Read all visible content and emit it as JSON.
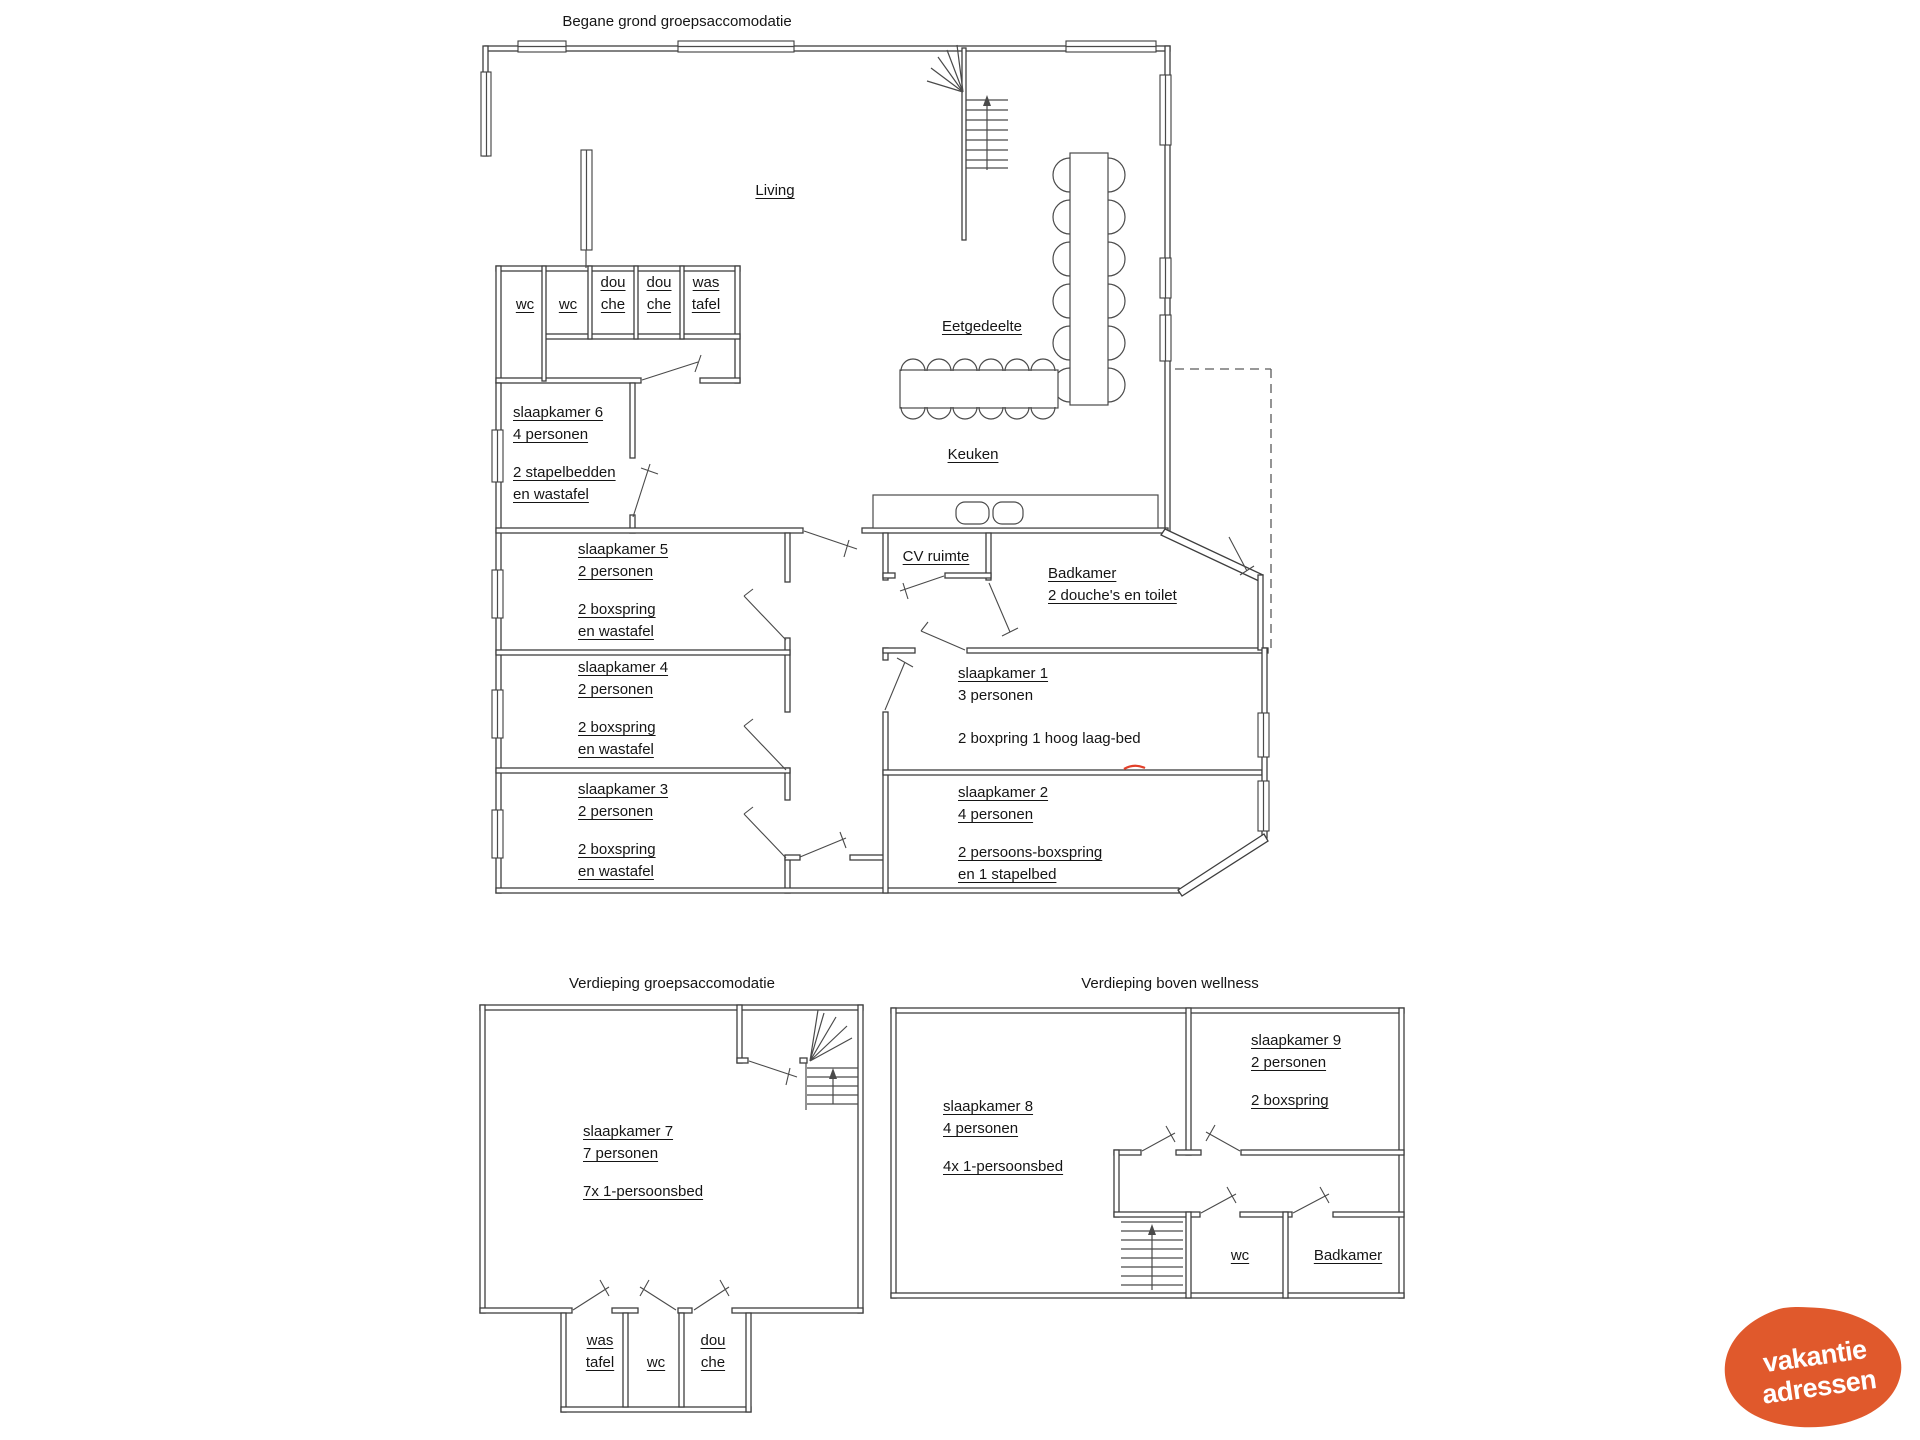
{
  "ground": {
    "title": "Begane grond groepsaccomodatie",
    "living": "Living",
    "eetgedeelte": "Eetgedeelte",
    "keuken": "Keuken",
    "cv_ruimte": "CV ruimte",
    "badkamer": {
      "name": "Badkamer",
      "desc": "2 douche's en toilet"
    },
    "wc_left": "wc",
    "wc_right": "wc",
    "douche_1": {
      "l1": "dou",
      "l2": "che"
    },
    "douche_2": {
      "l1": "dou",
      "l2": "che"
    },
    "wastafel": {
      "l1": "was",
      "l2": "tafel"
    },
    "sk6": {
      "name": "slaapkamer 6",
      "cap": "4 personen",
      "b1": "2 stapelbedden",
      "b2": "en wastafel"
    },
    "sk5": {
      "name": "slaapkamer 5",
      "cap": "2 personen",
      "b1": "2 boxspring",
      "b2": "en wastafel"
    },
    "sk4": {
      "name": "slaapkamer 4",
      "cap": "2 personen",
      "b1": "2 boxspring",
      "b2": "en wastafel"
    },
    "sk3": {
      "name": "slaapkamer 3",
      "cap": "2 personen",
      "b1": "2 boxspring",
      "b2": "en wastafel"
    },
    "sk1": {
      "name": "slaapkamer 1",
      "cap": "3 personen",
      "b1": "2 boxpring 1 hoog laag-bed"
    },
    "sk2": {
      "name": "slaapkamer 2",
      "cap": "4 personen",
      "b1": "2 persoons-boxspring",
      "b2": "en 1 stapelbed"
    }
  },
  "floor1": {
    "title": "Verdieping groepsaccomodatie",
    "sk7": {
      "name": "slaapkamer 7",
      "cap": "7 personen",
      "b1": "7x 1-persoonsbed"
    },
    "wastafel": {
      "l1": "was",
      "l2": "tafel"
    },
    "wc": "wc",
    "douche": {
      "l1": "dou",
      "l2": "che"
    }
  },
  "floor2": {
    "title": "Verdieping boven wellness",
    "sk8": {
      "name": "slaapkamer 8",
      "cap": "4 personen",
      "b1": "4x 1-persoonsbed"
    },
    "sk9": {
      "name": "slaapkamer 9",
      "cap": "2 personen",
      "b1": "2 boxspring"
    },
    "wc": "wc",
    "badkamer": "Badkamer"
  },
  "logo": {
    "line1": "vakantie",
    "line2": "adressen",
    "color": "#e0592c"
  }
}
